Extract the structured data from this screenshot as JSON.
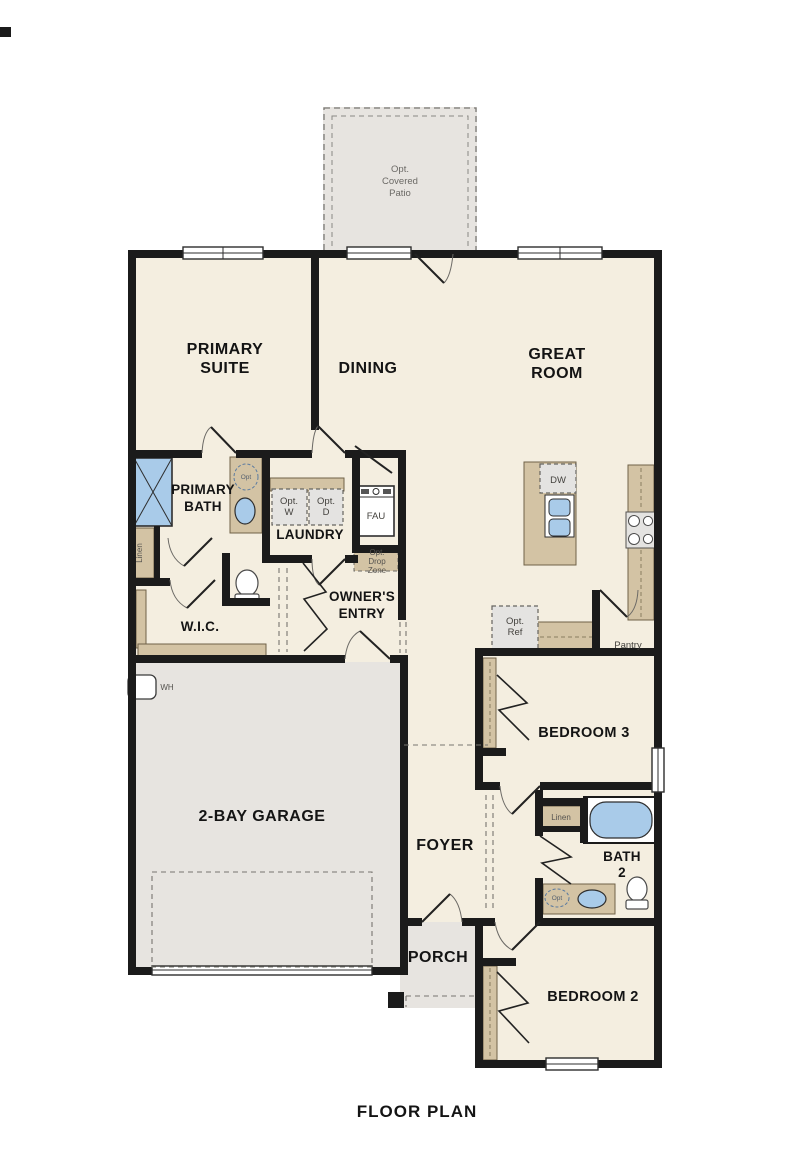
{
  "page": {
    "kind": "floor-plan-drawing"
  },
  "colors": {
    "wall": "#1b1b1b",
    "floor": "#f4eee0",
    "exterior_floor": "#e7e4e0",
    "cabinet_tan": "#d3c3a4",
    "appliance_gray": "#e4e3e1",
    "fixture_blue": "#a9cbe9"
  },
  "rooms": {
    "patio": {
      "lines": [
        "Opt.",
        "Covered",
        "Patio"
      ]
    },
    "primary_suite": {
      "lines": [
        "PRIMARY",
        "SUITE"
      ]
    },
    "dining": {
      "label": "DINING"
    },
    "great_room": {
      "lines": [
        "GREAT",
        "ROOM"
      ]
    },
    "primary_bath": {
      "lines": [
        "PRIMARY",
        "BATH"
      ]
    },
    "laundry": {
      "label": "LAUNDRY"
    },
    "owners_entry": {
      "lines": [
        "OWNER'S",
        "ENTRY"
      ]
    },
    "wic": {
      "label": "W.I.C."
    },
    "pantry": {
      "label": "Pantry"
    },
    "bedroom3": {
      "label": "BEDROOM 3"
    },
    "garage": {
      "label": "2-BAY GARAGE"
    },
    "foyer": {
      "label": "FOYER"
    },
    "bath2": {
      "lines": [
        "BATH",
        "2"
      ]
    },
    "bedroom2": {
      "label": "BEDROOM 2"
    },
    "porch": {
      "label": "PORCH"
    }
  },
  "fixtures": {
    "washer": {
      "lines": [
        "Opt.",
        "W"
      ]
    },
    "dryer": {
      "lines": [
        "Opt.",
        "D"
      ]
    },
    "fau": {
      "label": "FAU"
    },
    "drop_zone": {
      "lines": [
        "Opt.",
        "Drop",
        "Zone"
      ]
    },
    "fridge": {
      "lines": [
        "Opt.",
        "Ref"
      ]
    },
    "dishwasher": {
      "label": "DW"
    },
    "water_heater": {
      "label": "WH"
    },
    "linen_primary": {
      "label": "Linen"
    },
    "linen_bath2": {
      "label": "Linen"
    },
    "opt_sink_primary": {
      "label": "Opt"
    },
    "opt_sink_bath2": {
      "label": "Opt"
    }
  },
  "footer": {
    "title": "FLOOR PLAN"
  }
}
